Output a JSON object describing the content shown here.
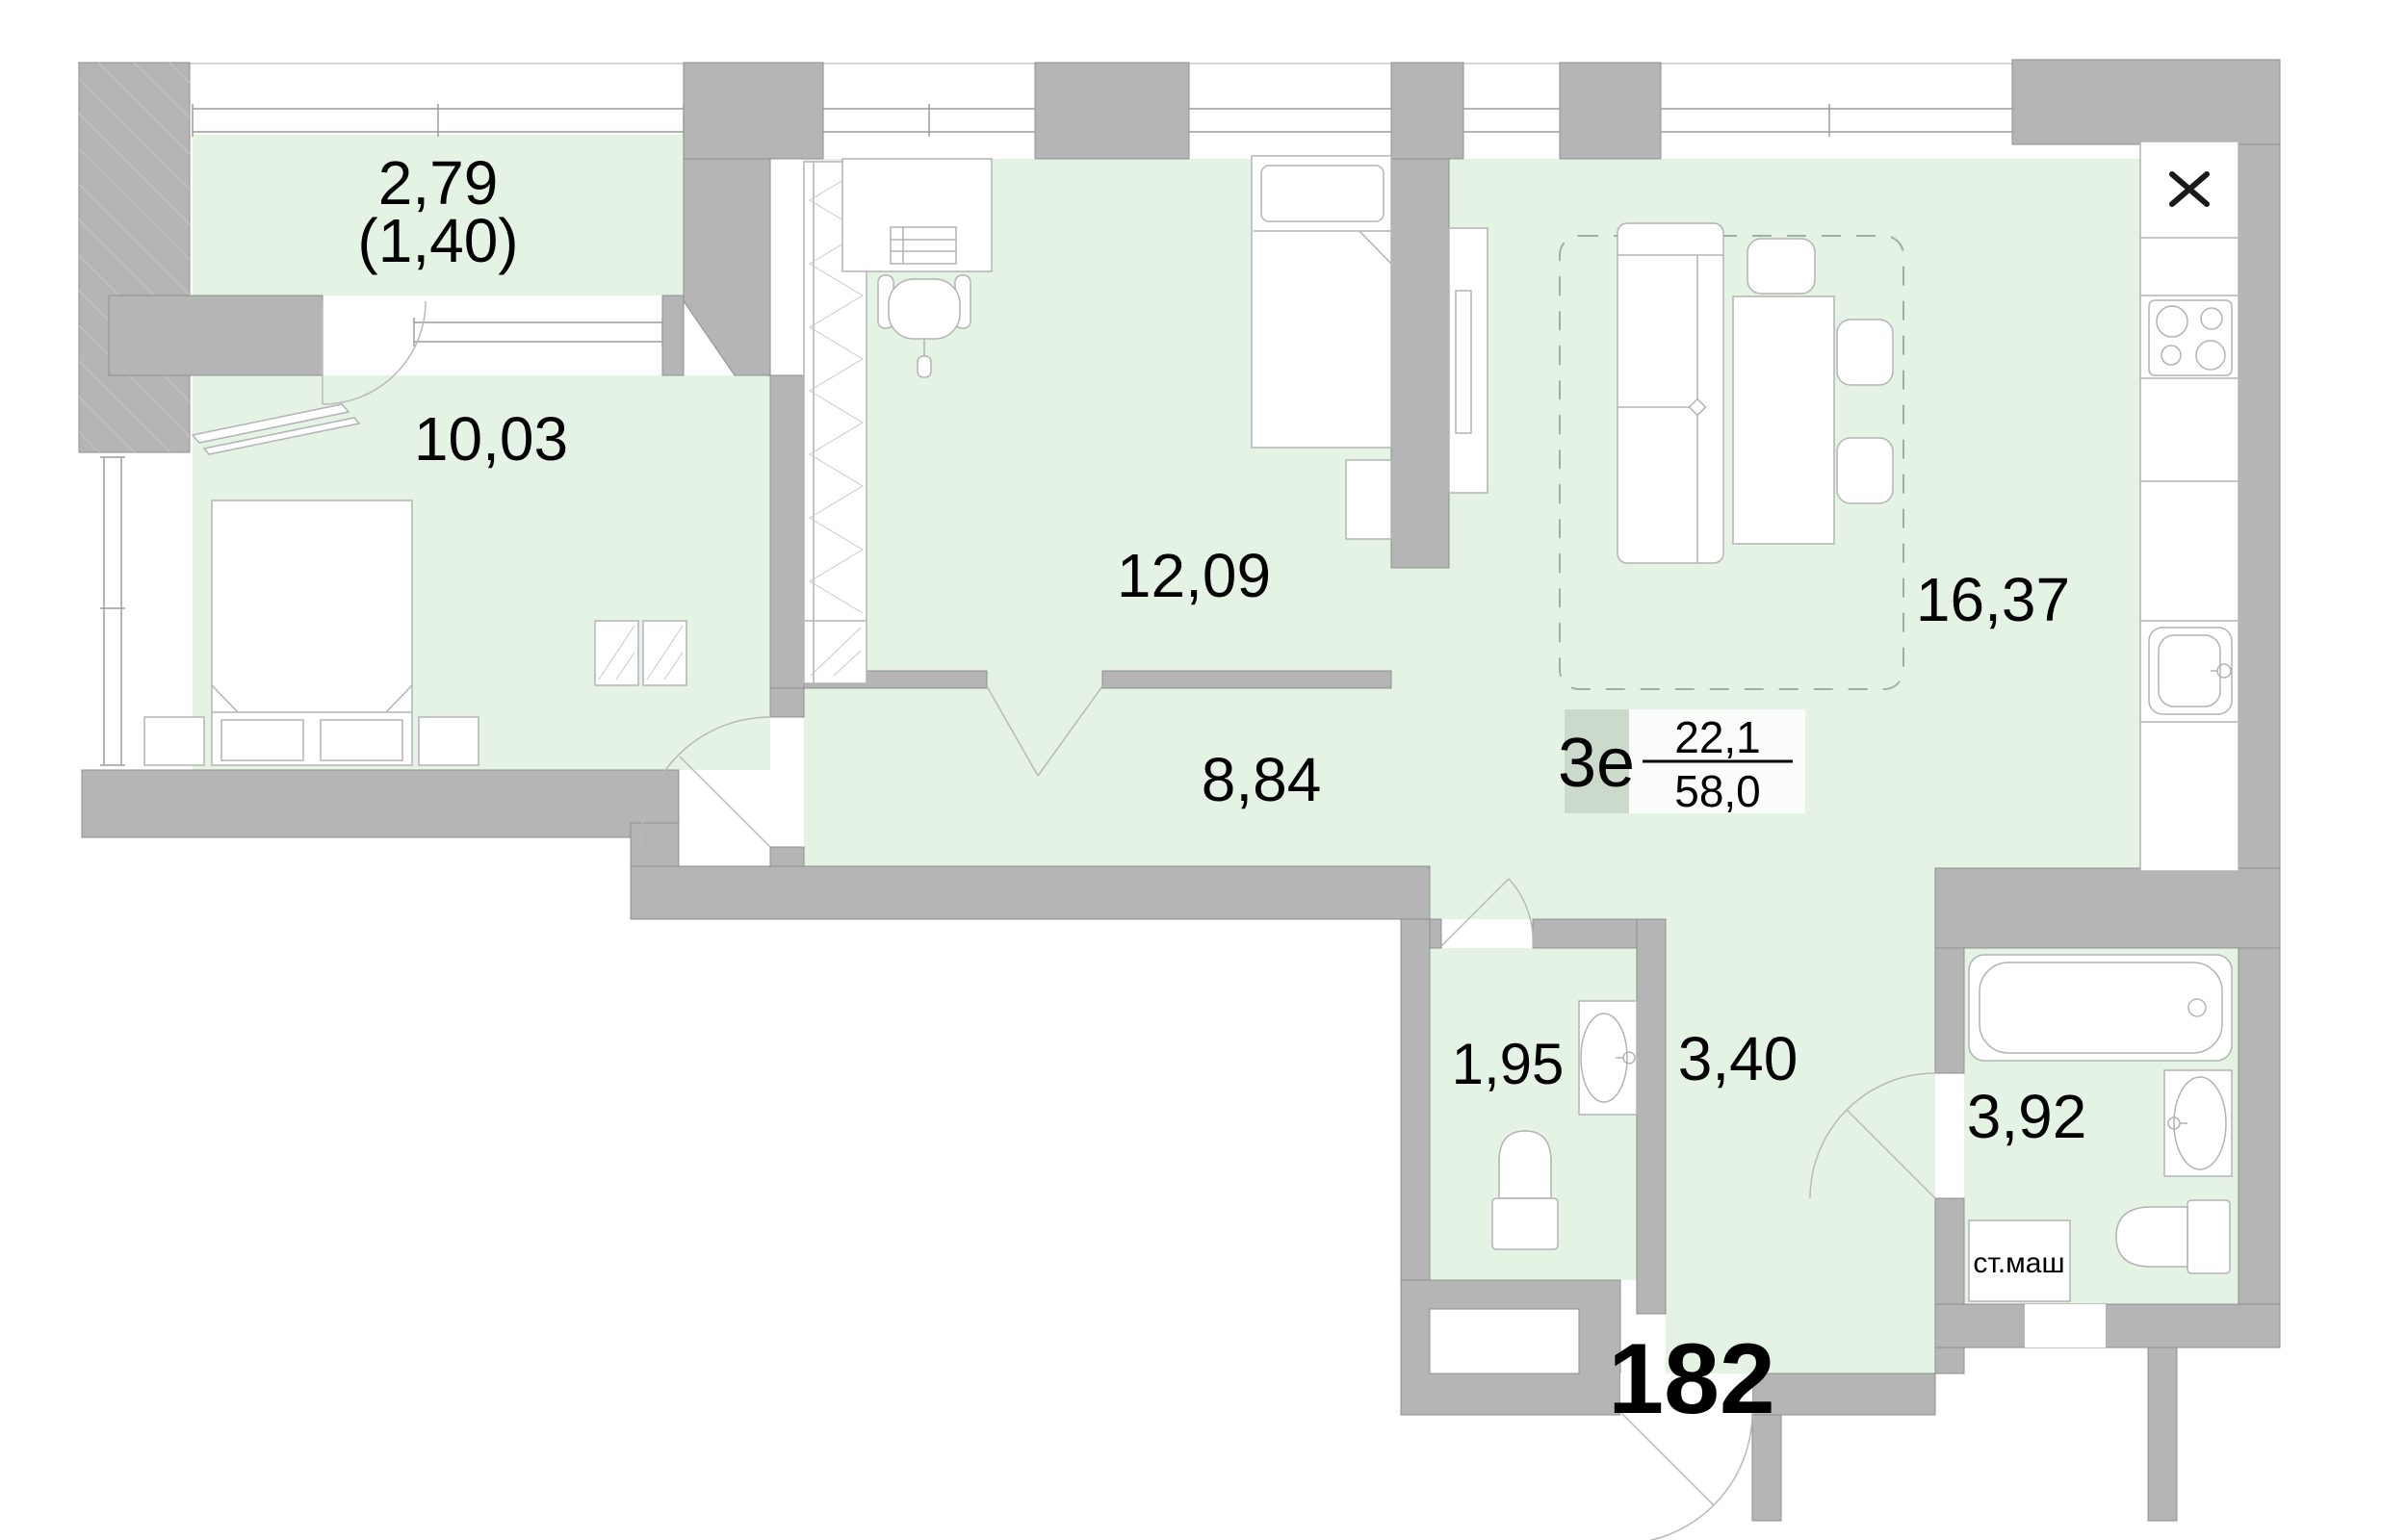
{
  "plan": {
    "rooms": {
      "balcony": {
        "area": "2,79",
        "area_note": "(1,40)"
      },
      "bedroom": {
        "area": "10,03"
      },
      "room": {
        "area": "12,09"
      },
      "kitchen_living": {
        "area": "16,37"
      },
      "hallway": {
        "area": "8,84"
      },
      "wc": {
        "area": "1,95"
      },
      "inner_corridor": {
        "area": "3,40"
      },
      "bathroom": {
        "area": "3,92"
      }
    },
    "apartment": {
      "type_label": "3е",
      "living_area": "22,1",
      "total_area": "58,0",
      "number": "182"
    },
    "appliances": {
      "washing_machine_label": "ст.маш"
    },
    "colors": {
      "floor": "#e4f3e3",
      "wall": "#b5b5b5",
      "type_box": "#ccdacb"
    }
  }
}
